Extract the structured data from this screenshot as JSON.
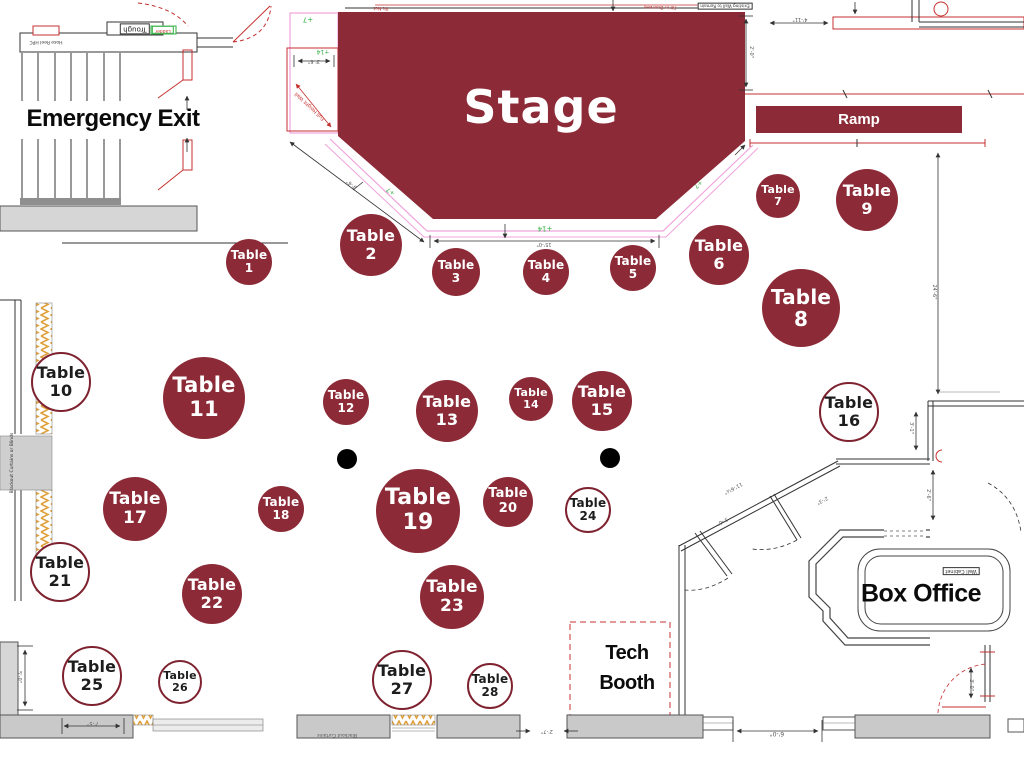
{
  "title": "Venue floor plan with stage and numbered tables",
  "colors": {
    "maroon": "#8c2b37",
    "wall_gray": "#d6d6d6",
    "line_red": "#c53030",
    "line_pink": "#f0a3dc",
    "elev_green": "#2fae3e",
    "hatch_orange": "#dfa13d",
    "ink": "#1c1c1c",
    "dim_text": "#555555"
  },
  "labels": {
    "stage": "Stage",
    "ramp": "Ramp",
    "emergency_exit": "Emergency Exit",
    "box_office": "Box Office",
    "tech_booth_line1": "Tech",
    "tech_booth_line2": "Booth",
    "table_word": "Table"
  },
  "tables": [
    {
      "number": "1",
      "x": 249,
      "y": 262,
      "r": 23,
      "filled": true
    },
    {
      "number": "2",
      "x": 371,
      "y": 245,
      "r": 31,
      "filled": true
    },
    {
      "number": "3",
      "x": 456,
      "y": 272,
      "r": 24,
      "filled": true
    },
    {
      "number": "4",
      "x": 546,
      "y": 272,
      "r": 23,
      "filled": true
    },
    {
      "number": "5",
      "x": 633,
      "y": 268,
      "r": 23,
      "filled": true
    },
    {
      "number": "6",
      "x": 719,
      "y": 255,
      "r": 30,
      "filled": true
    },
    {
      "number": "7",
      "x": 778,
      "y": 196,
      "r": 22,
      "filled": true
    },
    {
      "number": "8",
      "x": 801,
      "y": 308,
      "r": 39,
      "filled": true
    },
    {
      "number": "9",
      "x": 867,
      "y": 200,
      "r": 31,
      "filled": true
    },
    {
      "number": "10",
      "x": 61,
      "y": 382,
      "r": 30,
      "filled": false
    },
    {
      "number": "11",
      "x": 204,
      "y": 398,
      "r": 41,
      "filled": true
    },
    {
      "number": "12",
      "x": 346,
      "y": 402,
      "r": 23,
      "filled": true
    },
    {
      "number": "13",
      "x": 447,
      "y": 411,
      "r": 31,
      "filled": true
    },
    {
      "number": "14",
      "x": 531,
      "y": 399,
      "r": 22,
      "filled": true
    },
    {
      "number": "15",
      "x": 602,
      "y": 401,
      "r": 30,
      "filled": true
    },
    {
      "number": "16",
      "x": 849,
      "y": 412,
      "r": 30,
      "filled": false
    },
    {
      "number": "17",
      "x": 135,
      "y": 509,
      "r": 32,
      "filled": true
    },
    {
      "number": "18",
      "x": 281,
      "y": 509,
      "r": 23,
      "filled": true
    },
    {
      "number": "19",
      "x": 418,
      "y": 511,
      "r": 42,
      "filled": true
    },
    {
      "number": "20",
      "x": 508,
      "y": 502,
      "r": 25,
      "filled": true
    },
    {
      "number": "21",
      "x": 60,
      "y": 572,
      "r": 30,
      "filled": false
    },
    {
      "number": "22",
      "x": 212,
      "y": 594,
      "r": 30,
      "filled": true
    },
    {
      "number": "23",
      "x": 452,
      "y": 597,
      "r": 32,
      "filled": true
    },
    {
      "number": "24",
      "x": 588,
      "y": 510,
      "r": 23,
      "filled": false
    },
    {
      "number": "25",
      "x": 92,
      "y": 676,
      "r": 30,
      "filled": false
    },
    {
      "number": "26",
      "x": 180,
      "y": 682,
      "r": 22,
      "filled": false
    },
    {
      "number": "27",
      "x": 402,
      "y": 680,
      "r": 30,
      "filled": false
    },
    {
      "number": "28",
      "x": 490,
      "y": 686,
      "r": 23,
      "filled": false
    }
  ],
  "pillars": [
    {
      "x": 347,
      "y": 459,
      "r": 10
    },
    {
      "x": 610,
      "y": 458,
      "r": 10
    }
  ],
  "annotations": [
    {
      "t": "Trough",
      "x": 135,
      "y": 29,
      "r": 180,
      "s": 7,
      "c": "#222222",
      "box": true
    },
    {
      "t": "Ladder",
      "x": 163,
      "y": 30,
      "r": 180,
      "s": 4.5,
      "c": "#c53030",
      "box": true,
      "bc": "#2fae3e"
    },
    {
      "t": "Hose Reel HPC",
      "x": 46,
      "y": 41,
      "r": 180,
      "s": 4.5,
      "c": "#333333"
    },
    {
      "t": "Pit Net",
      "x": 381,
      "y": 7,
      "r": 180,
      "s": 4.5,
      "c": "#c53030"
    },
    {
      "t": "Fill in Doorway",
      "x": 660,
      "y": 6,
      "r": 180,
      "s": 4.5,
      "c": "#c53030"
    },
    {
      "t": "Existing Wall to Remain",
      "x": 725,
      "y": 6,
      "r": 180,
      "s": 4.2,
      "c": "#333333",
      "box": true
    },
    {
      "t": "4'-11\"",
      "x": 800,
      "y": 19,
      "r": 180,
      "s": 5,
      "c": "#555555"
    },
    {
      "t": "2'-0\"",
      "x": 751,
      "y": 52,
      "r": 90,
      "s": 5,
      "c": "#555555"
    },
    {
      "t": "+7",
      "x": 308,
      "y": 19,
      "r": 180,
      "s": 7,
      "c": "#2fae3e"
    },
    {
      "t": "+14",
      "x": 323,
      "y": 51,
      "r": 180,
      "s": 6,
      "c": "#2fae3e"
    },
    {
      "t": "3'-6\"",
      "x": 314,
      "y": 61,
      "r": 180,
      "s": 5,
      "c": "#555555"
    },
    {
      "t": "Full Height Wall",
      "x": 310,
      "y": 106,
      "r": 223,
      "s": 5,
      "c": "#c53030"
    },
    {
      "t": "9'-6\"",
      "x": 352,
      "y": 184,
      "r": 217,
      "s": 5,
      "c": "#555555"
    },
    {
      "t": "+7",
      "x": 391,
      "y": 191,
      "r": 217,
      "s": 6,
      "c": "#2fae3e"
    },
    {
      "t": "+14",
      "x": 545,
      "y": 228,
      "r": 180,
      "s": 7,
      "c": "#2fae3e"
    },
    {
      "t": "15'-0\"",
      "x": 544,
      "y": 244,
      "r": 180,
      "s": 5,
      "c": "#555555"
    },
    {
      "t": "+7",
      "x": 698,
      "y": 184,
      "r": 140,
      "s": 6,
      "c": "#2fae3e"
    },
    {
      "t": "24'-6\"",
      "x": 934,
      "y": 292,
      "r": 90,
      "s": 5,
      "c": "#555555"
    },
    {
      "t": "3'-1\"",
      "x": 911,
      "y": 428,
      "r": 90,
      "s": 5,
      "c": "#555555"
    },
    {
      "t": "2'-6\"",
      "x": 928,
      "y": 495,
      "r": 90,
      "s": 5,
      "c": "#555555"
    },
    {
      "t": "11'-6½\"",
      "x": 733,
      "y": 488,
      "r": 152,
      "s": 5,
      "c": "#555555"
    },
    {
      "t": "3'-0\"",
      "x": 722,
      "y": 521,
      "r": 152,
      "s": 5,
      "c": "#555555"
    },
    {
      "t": "2'-3\"",
      "x": 822,
      "y": 500,
      "r": 152,
      "s": 5,
      "c": "#555555"
    },
    {
      "t": "Wall Cabinet",
      "x": 961,
      "y": 571,
      "r": 180,
      "s": 5,
      "c": "#333333",
      "box": true
    },
    {
      "t": "Blackout Curtains or Blinds",
      "x": 13,
      "y": 463,
      "r": -90,
      "s": 4.5,
      "c": "#333333"
    },
    {
      "t": "5'-0\"",
      "x": 19,
      "y": 677,
      "r": 90,
      "s": 5,
      "c": "#555555"
    },
    {
      "t": "7'-5\"",
      "x": 93,
      "y": 723,
      "r": 180,
      "s": 5,
      "c": "#555555"
    },
    {
      "t": "Blackout Curtains",
      "x": 337,
      "y": 734,
      "r": 180,
      "s": 4.5,
      "c": "#555555"
    },
    {
      "t": "2'-7\"",
      "x": 547,
      "y": 731,
      "r": 180,
      "s": 5,
      "c": "#555555"
    },
    {
      "t": "6'-0\"",
      "x": 777,
      "y": 733,
      "r": 180,
      "s": 6,
      "c": "#555555"
    },
    {
      "t": "3'-0\"",
      "x": 971,
      "y": 685,
      "r": 90,
      "s": 5,
      "c": "#555555"
    }
  ]
}
